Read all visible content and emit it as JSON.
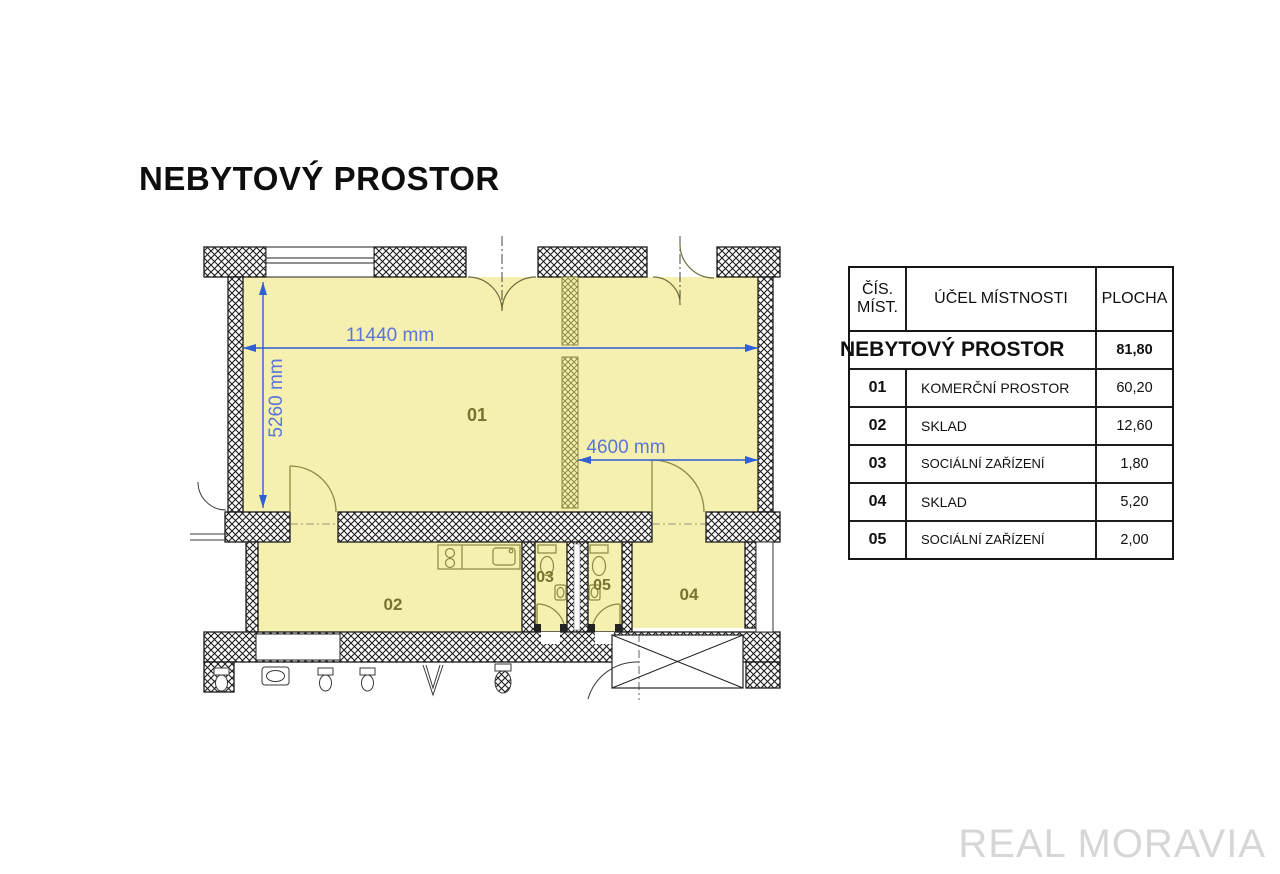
{
  "page": {
    "title": "NEBYTOVÝ PROSTOR",
    "watermark": "REAL MORAVIA"
  },
  "floor_plan": {
    "room_labels": {
      "r01": "01",
      "r02": "02",
      "r03": "03",
      "r04": "04",
      "r05": "05"
    },
    "dimensions": {
      "width": "11440 mm",
      "height": "5260 mm",
      "partition": "4600 mm"
    },
    "colors": {
      "room_fill": "#f5efb0",
      "wall_ink": "#1b1b1b",
      "partition_ink": "#8c8a42",
      "dimension_line": "#2f5fd5",
      "dimension_text": "#5b76d8",
      "room_label": "#76742e",
      "watermark": "#d6d6d6"
    }
  },
  "legend_table": {
    "headers": {
      "number": "ČÍS. MÍST.",
      "purpose": "ÚČEL MÍSTNOSTI",
      "area": "PLOCHA"
    },
    "summary": {
      "label": "NEBYTOVÝ PROSTOR",
      "area": "81,80"
    },
    "rows": [
      {
        "number": "01",
        "purpose": "KOMERČNÍ PROSTOR",
        "area": "60,20"
      },
      {
        "number": "02",
        "purpose": "SKLAD",
        "area": "12,60"
      },
      {
        "number": "03",
        "purpose": "SOCIÁLNÍ ZAŘÍZENÍ",
        "area": "1,80"
      },
      {
        "number": "04",
        "purpose": "SKLAD",
        "area": "5,20"
      },
      {
        "number": "05",
        "purpose": "SOCIÁLNÍ ZAŘÍZENÍ",
        "area": "2,00"
      }
    ]
  }
}
